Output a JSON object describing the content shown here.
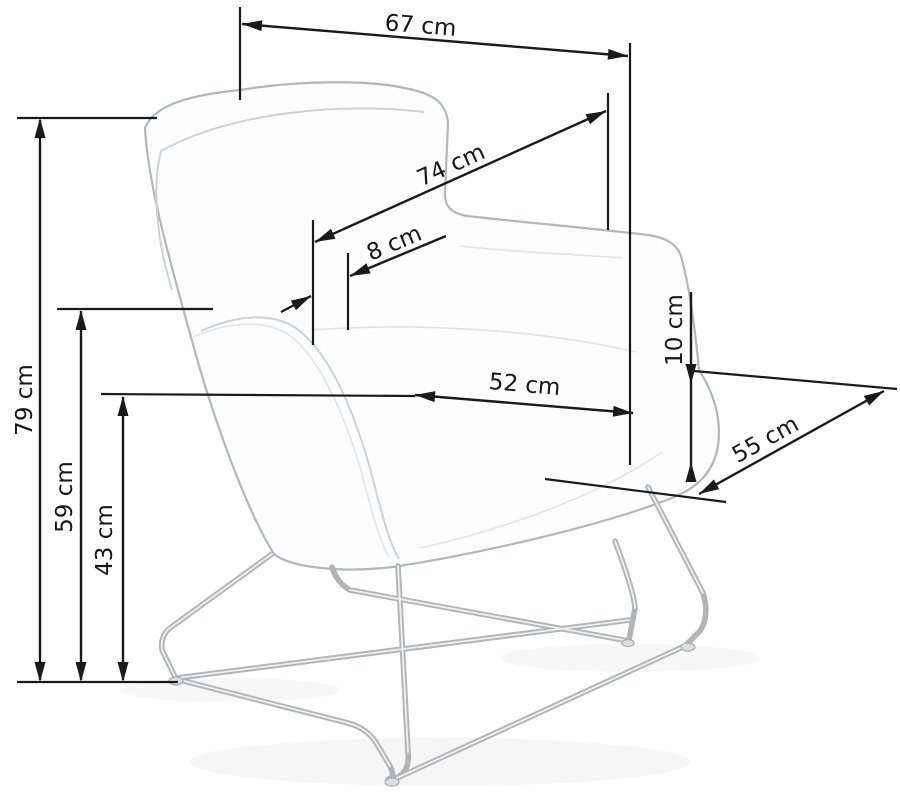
{
  "drawing": {
    "subject": "armchair-technical-dimension-drawing",
    "unit": "cm",
    "dimensions": [
      {
        "id": "overall-width",
        "label": "67 cm",
        "value": 67
      },
      {
        "id": "back-diagonal",
        "label": "74 cm",
        "value": 74
      },
      {
        "id": "back-offset",
        "label": "8 cm",
        "value": 8
      },
      {
        "id": "overall-height",
        "label": "79 cm",
        "value": 79
      },
      {
        "id": "armrest-height",
        "label": "59 cm",
        "value": 59
      },
      {
        "id": "seat-height",
        "label": "43 cm",
        "value": 43
      },
      {
        "id": "seat-width",
        "label": "52 cm",
        "value": 52
      },
      {
        "id": "armrest-above-seat",
        "label": "10 cm",
        "value": 10
      },
      {
        "id": "seat-depth",
        "label": "55 cm",
        "value": 55
      }
    ],
    "colors": {
      "dimension_line": "#1a1a1a",
      "chair_line": "#b4b7ba",
      "background": "#ffffff"
    }
  }
}
